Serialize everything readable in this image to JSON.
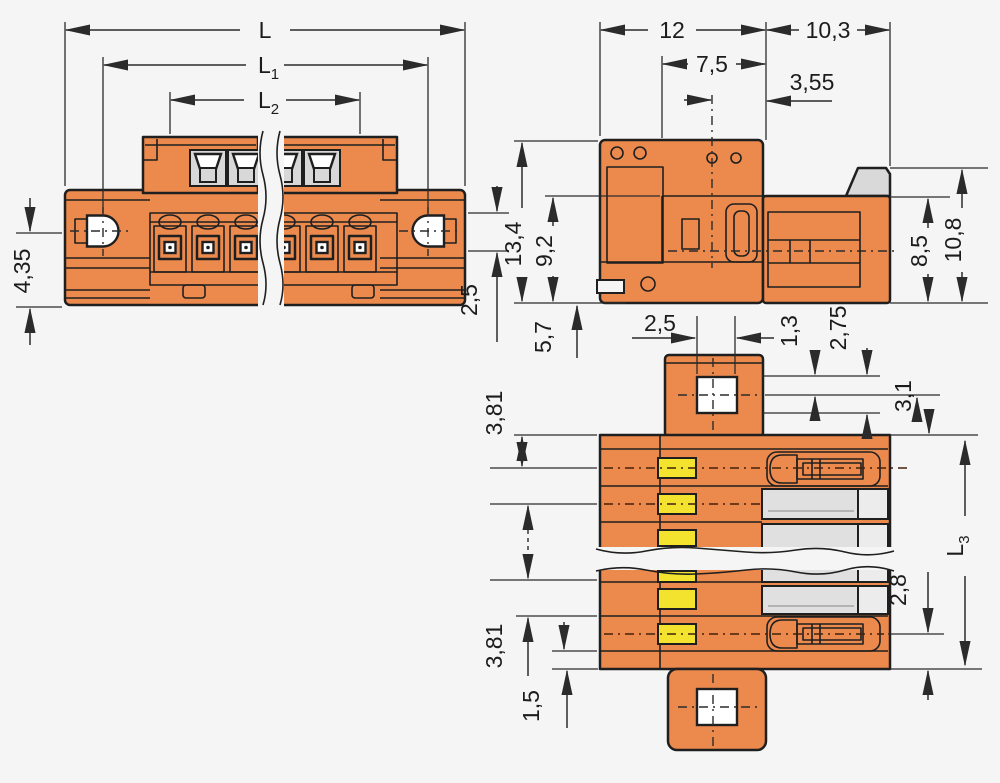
{
  "drawing": {
    "type": "technical-dimension-drawing",
    "subject": "male-header-connector-3-views",
    "colors": {
      "background": "#f5f5f5",
      "housing_orange": "#ec8a4e",
      "contact_yellow": "#f3e32e",
      "contact_gray": "#e0e0e0",
      "latch_gray": "#d9d9d9",
      "line_black": "#1f1f1f"
    },
    "views": {
      "front": {
        "name": "front view",
        "dims": {
          "L": "L",
          "L1_base": "L",
          "L1_sub": "1",
          "L2_base": "L",
          "L2_sub": "2",
          "h435": "4,35",
          "h25": "2,5"
        }
      },
      "side": {
        "name": "side view",
        "dims": {
          "w12": "12",
          "w103": "10,3",
          "w75": "7,5",
          "w355": "3,55",
          "h134": "13,4",
          "h92": "9,2",
          "h57": "5,7",
          "h85": "8,5",
          "h108": "10,8"
        }
      },
      "bottom": {
        "name": "bottom view",
        "dims": {
          "w25": "2,5",
          "h13": "1,3",
          "h275": "2,75",
          "h31": "3,1",
          "p381_top": "3,81",
          "p381_bottom": "3,81",
          "h15": "1,5",
          "h28": "2,8",
          "L3_base": "L",
          "L3_sub": "3"
        }
      }
    }
  }
}
